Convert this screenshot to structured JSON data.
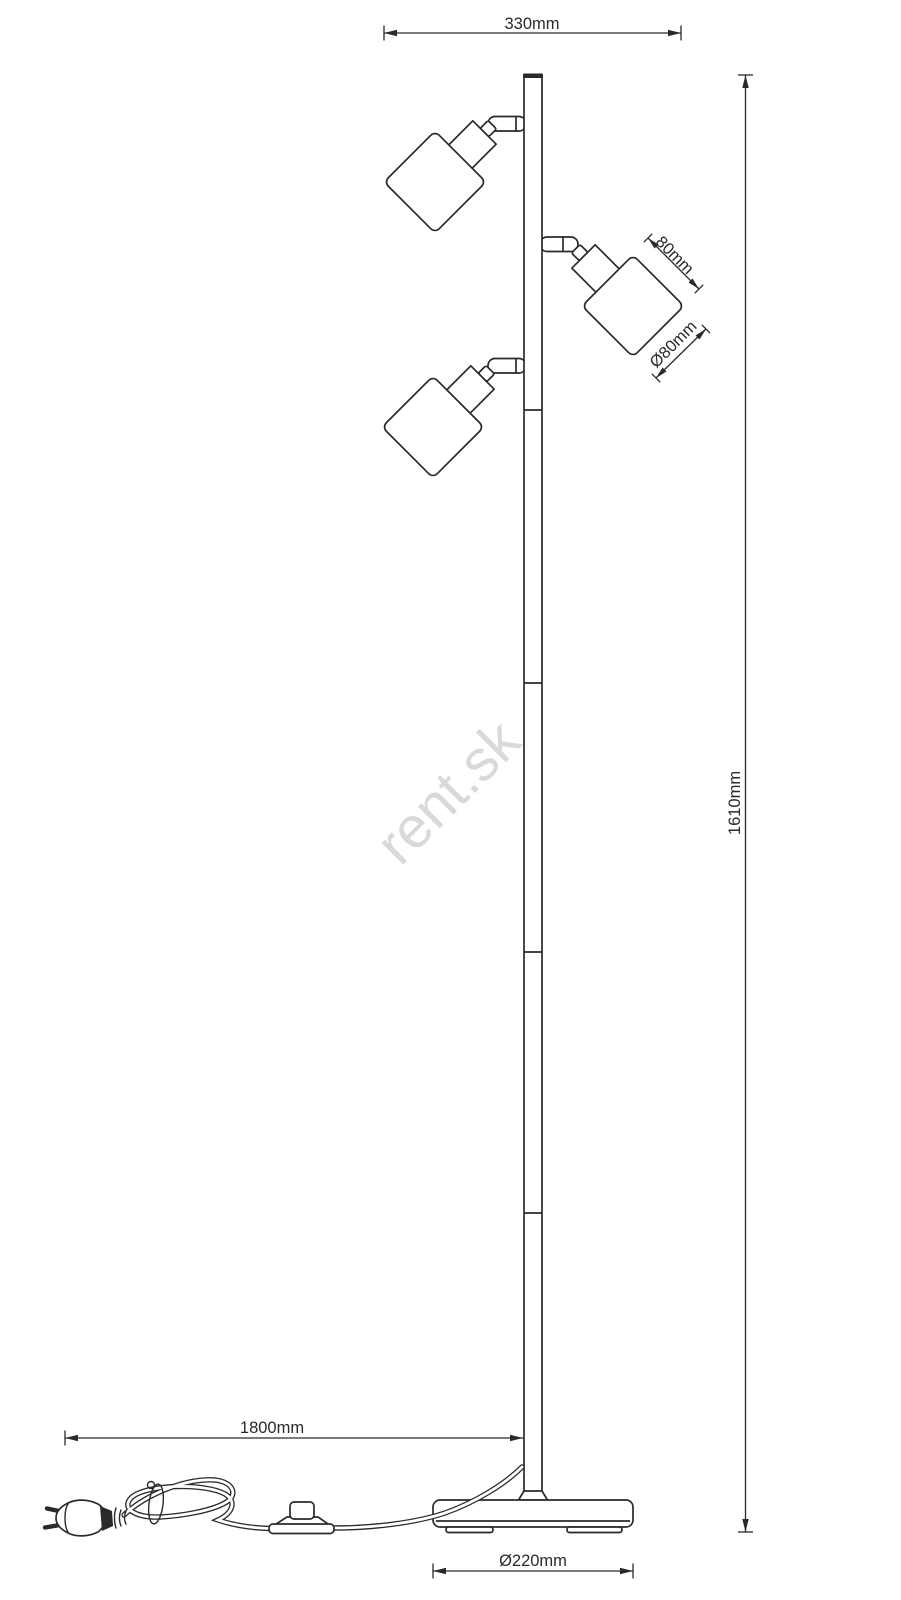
{
  "drawing": {
    "dimensions": {
      "top_width": "330mm",
      "total_height": "1610mm",
      "shade_height": "80mm",
      "shade_diameter": "Ø80mm",
      "cable_length": "1800mm",
      "base_diameter": "Ø220mm"
    },
    "watermark": "rent.sk",
    "colors": {
      "line": "#2a2a2a",
      "watermark": "#d9d9d9",
      "background": "#ffffff"
    }
  }
}
